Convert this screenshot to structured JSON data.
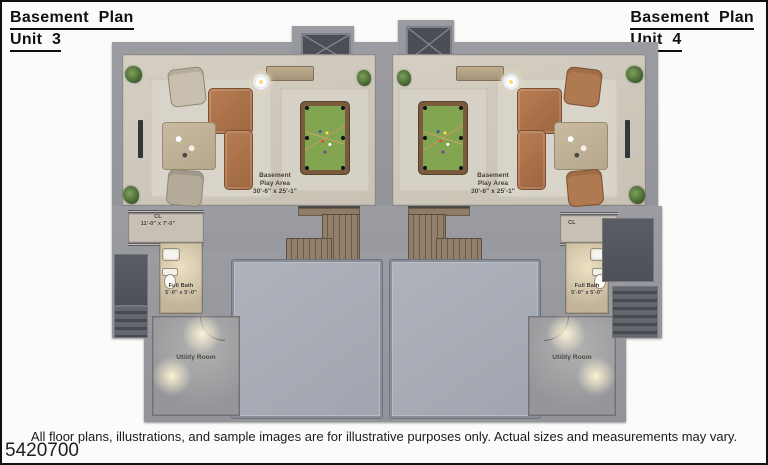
{
  "titles": {
    "left": {
      "line1": "Basement Plan",
      "line2": "Unit 3"
    },
    "right": {
      "line1": "Basement Plan",
      "line2": "Unit 4"
    }
  },
  "units": [
    {
      "name": "Unit 3",
      "play_area_label": {
        "line1": "Basement",
        "line2": "Play Area",
        "line3": "30'-6\" x 25'-1\""
      },
      "closet": {
        "label": "CL",
        "dims": "11'-0\" x 7'-0\""
      },
      "bath": {
        "label": "Full Bath",
        "dims": "5'-0\" x 5'-0\""
      },
      "utility_label": "Utility Room"
    },
    {
      "name": "Unit 4",
      "play_area_label": {
        "line1": "Basement",
        "line2": "Play Area",
        "line3": "30'-6\" x 25'-1\""
      },
      "closet": {
        "label": "CL"
      },
      "bath": {
        "label": "Full Bath",
        "dims": "5'-0\" x 5'-0\""
      },
      "utility_label": "Utility Room"
    }
  ],
  "footer": {
    "disclaimer": "All floor plans, illustrations, and sample images are for illustrative purposes only. Actual sizes and measurements may vary.",
    "corner_text": "5420700"
  },
  "colors": {
    "wall": "#97989d",
    "floor": "#cfc9bd",
    "slab": "#a9adb6",
    "stair_wood": "#8d7a64",
    "pool_felt": "#82a550",
    "sofa": "#ad7347",
    "dark_area": "#54565e",
    "title_text": "#111111"
  }
}
